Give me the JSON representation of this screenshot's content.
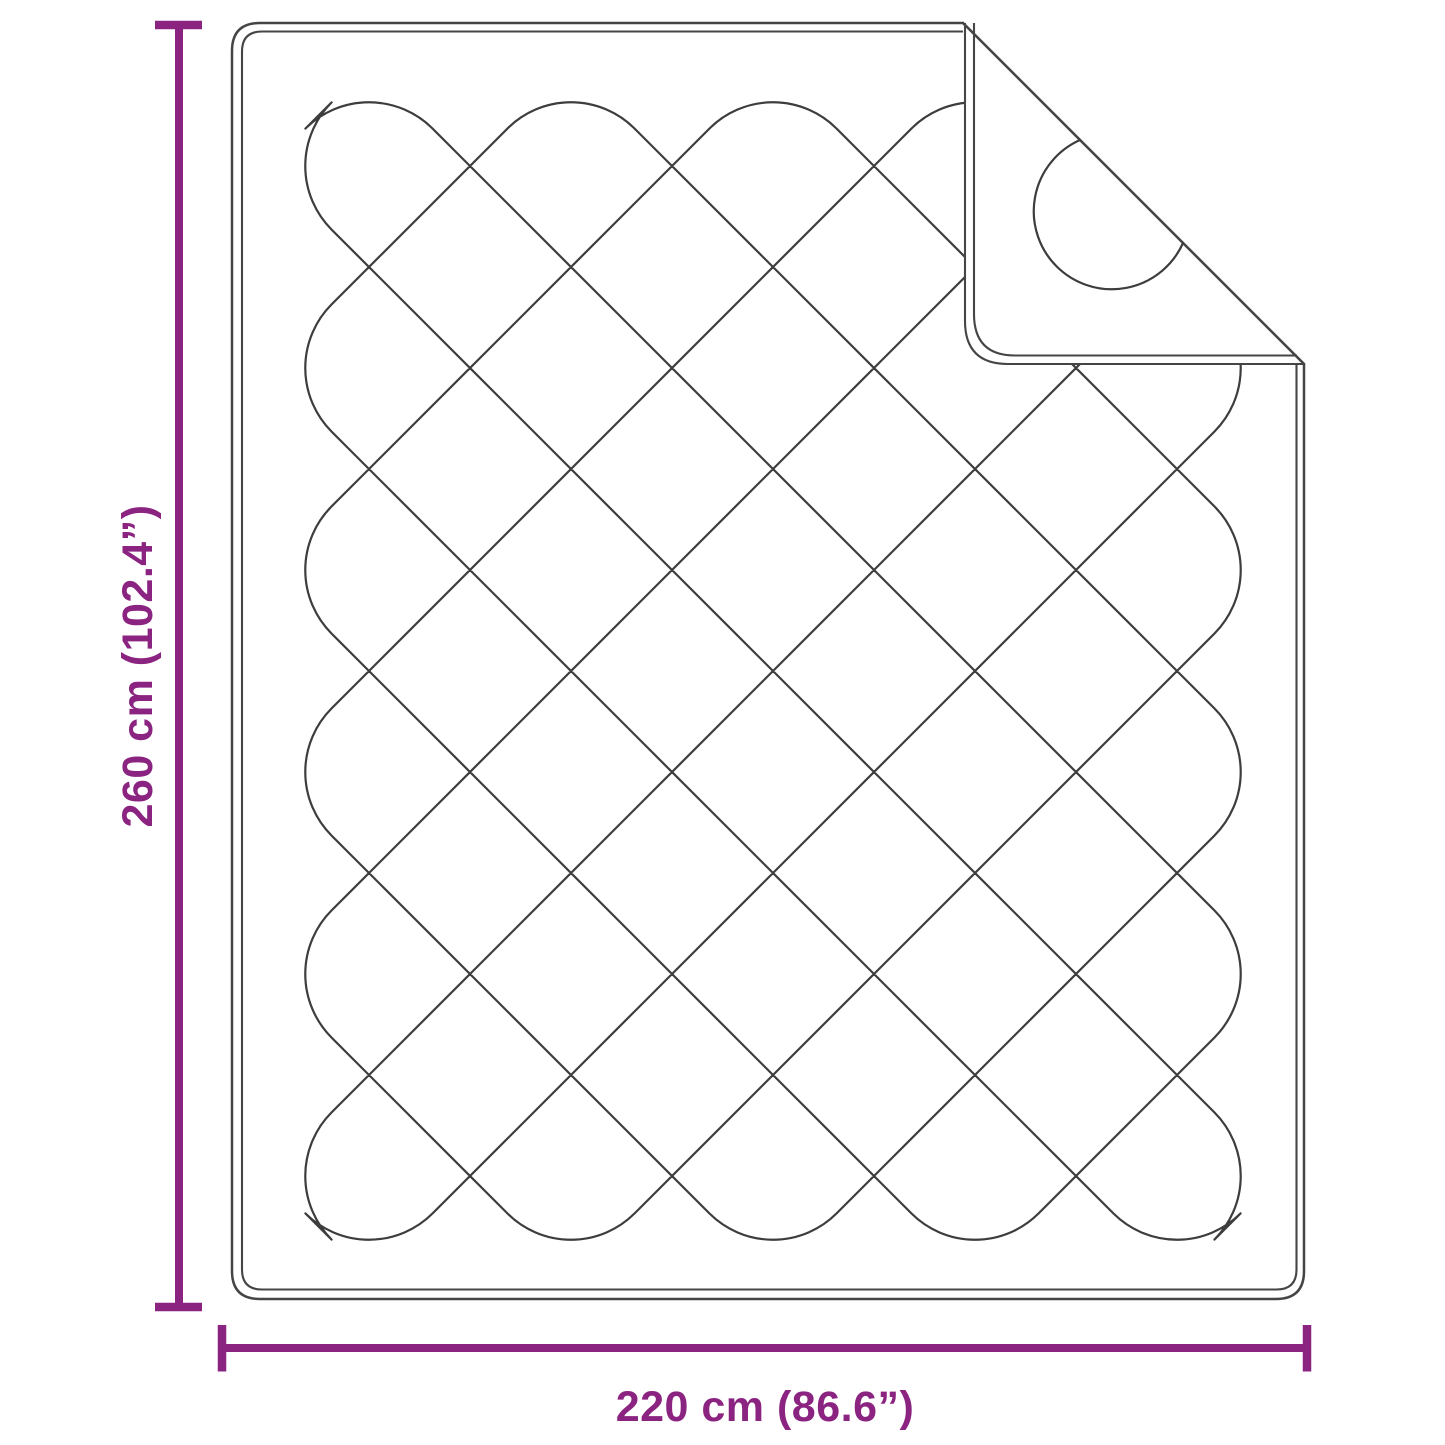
{
  "diagram": {
    "subject": "quilted-blanket-top-view-with-folded-corner",
    "dimensions": {
      "height": {
        "label": "260 cm (102.4”)",
        "value_cm": 260,
        "value_inch": 102.4
      },
      "width": {
        "label": "220 cm (86.6”)",
        "value_cm": 220,
        "value_inch": 86.6
      }
    },
    "colors": {
      "dimension_accent": "#8b2381",
      "outline": "#454545",
      "stitch": "#3d3d3d",
      "background": "#ffffff"
    }
  }
}
